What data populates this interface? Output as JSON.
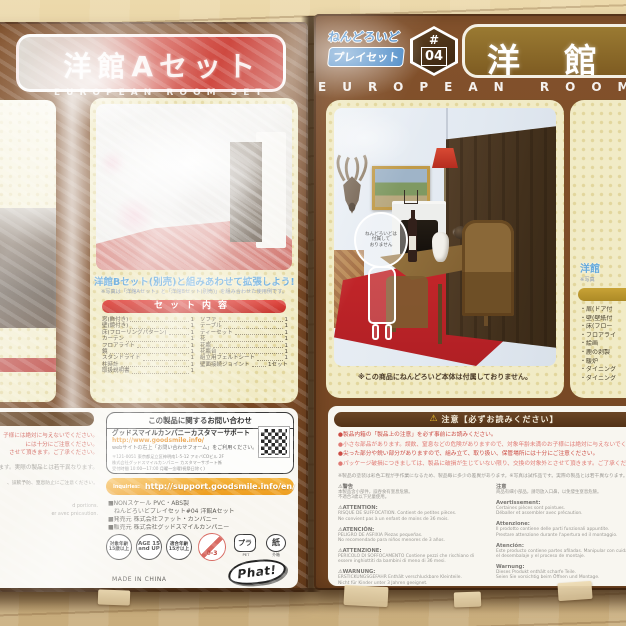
{
  "left_box": {
    "title": "洋館Aセット",
    "subtitle": "EUROPEAN ROOM SET",
    "headline": "洋館Bセット(別売)と組みあわせて拡張しよう!!",
    "headline_note": "※写真は「洋館Aセット」と「洋館Bセット(別売)」を組み合わせた使用例です。",
    "contents_header": "セット内容",
    "contents_col1": [
      {
        "name": "窓(飾付き)",
        "qty": "1"
      },
      {
        "name": "壁(鏡付き)",
        "qty": "1"
      },
      {
        "name": "床(フローリングパターン)",
        "qty": "1"
      },
      {
        "name": "カーテン",
        "qty": "1"
      },
      {
        "name": "フロアライト",
        "qty": "1"
      },
      {
        "name": "鏡",
        "qty": "1"
      },
      {
        "name": "スタンドライト",
        "qty": "1"
      },
      {
        "name": "柱時計",
        "qty": "1"
      },
      {
        "name": "取扱説明書",
        "qty": "1"
      }
    ],
    "contents_col2": [
      {
        "name": "ソファ",
        "qty": "1"
      },
      {
        "name": "テーブル",
        "qty": "1"
      },
      {
        "name": "ティーセット",
        "qty": "1"
      },
      {
        "name": "花",
        "qty": "1"
      },
      {
        "name": "花瓶",
        "qty": "1"
      },
      {
        "name": "花瓶台",
        "qty": "1"
      },
      {
        "name": "組立用フェルトシート",
        "qty": "1"
      },
      {
        "name": "壁面接続ジョイント",
        "qty": "1セット"
      }
    ],
    "warning_fragments": [
      "子様には絶対に与えないでください。",
      "には十分にご注意ください。",
      "させて頂きます。ご了承ください。",
      "ます。実際の製品とは若干異なります。",
      "、誤飲予防、窒息防止にご注意ください。",
      "d portions.",
      "er avec précaution."
    ],
    "contact": {
      "header": "この製品に関するお問い合わせ",
      "support": "グッドスマイルカンパニーカスタマーサポート",
      "url": "http://www.goodsmile.info/",
      "web_note": "webサイトの右上「お問い合わせフォーム」をご利用ください。",
      "address1": "〒121-0051 東京都足立区神明南1-5-12 アキバCOビル 2F",
      "address2": "株式会社グッドスマイルカンパニー カスタマーサポート係",
      "address3": "受付時間 10:00〜17:00 月曜〜金曜(祝祭日除く)"
    },
    "en_support_label": "Inquiries:",
    "en_support_url": "http://support.goodsmile.info/en/",
    "specs": [
      "■NONスケール PVC・ABS製",
      "ねんどろいどプレイセット#04 洋館Aセット",
      "■発売元 株式会社ファット・カンパニー",
      "■販売元 株式会社グッドスマイルカンパニー"
    ],
    "badges": {
      "age_jp": "対象年齢\n15歳以上",
      "age_en": "AGE 15\nand UP",
      "age_fit": "適合年齢\n15才以上",
      "ban": "0-3",
      "plastic": "プラ",
      "plastic_sub": "PET",
      "paper": "紙",
      "paper_sub": "外箱"
    },
    "maker_logo": "Phat!",
    "made_in": "MADE IN CHINA"
  },
  "right_box": {
    "logo_line1": "ねんどろいど",
    "logo_line2": "プレイセット",
    "badge_hash": "#",
    "badge_number": "04",
    "title": "洋館",
    "subtitle": "EUROPEAN ROOM",
    "figure_note": "ねんどろいどは\n付属して\nおりません",
    "photo_caption": "※この商品にねんどろいど本体は付属しておりません。",
    "side_panel": {
      "headline_fragment": "洋館",
      "note_fragment": "※写真",
      "items": [
        "扉(ドア付",
        "壁(壁紙付",
        "床(フロー",
        "フロアライ",
        "絵画",
        "鹿の剥製",
        "暖炉",
        "ダイニング",
        "ダイニング"
      ]
    },
    "warning": {
      "bar_icon": "⚠",
      "bar_text": "注意【必ずお読みください】",
      "bullets": [
        "●製品内箱の「製品上の注意」を必ず事前にお読みください。",
        "●小さな部品があります。誤飲、窒息などの危険がありますので、対象年齢未満のお子様には絶対に与えないでください。",
        "●尖った部分や鋭い部分がありますので、組み立て、取り扱い、保管場所には十分にご注意ください。",
        "●パッケージ破損につきましては、製品に破損が生じていない限り、交換の対象外とさせて頂きます。ご了承ください。"
      ],
      "note": "※製品の塗装は彩色工程が手作業になるため、製品毎に多少の差異があります。※写真は試作品です。実際の製品とは若干異なります。",
      "col_left": [
        {
          "head": "⚠警告",
          "body": "本製品含小部件，誤吞食有窒息危險。\n不適合3歲以下兒童使用。"
        },
        {
          "head": "⚠ATTENTION:",
          "body": "RISQUE DE SUFFOCATION. Contient de petites pièces.\nNe convient pas à un enfant de moins de 36 mois."
        },
        {
          "head": "⚠ATENCIÓN:",
          "body": "PELIGRO DE ASFIXIA Piezas pequeñas.\nNo recomendado para niños menores de 3 años."
        },
        {
          "head": "⚠ATTENZIONE:",
          "body": "PERICOLO DI SOFFOCAMENTO Contiene pezzi che rischiano di essere inghiottiti da bambini di meno di 36 mesi."
        },
        {
          "head": "⚠WARNUNG:",
          "body": "ERSTICKUNGSGEFAHR Enthält verschluckbare Kleinteile.\nNicht für Kinder unter 3 Jahren geeignet."
        }
      ],
      "col_right": [
        {
          "head": "注意",
          "body": "商品有細小部品，請勿放入口鼻，以免發生窒息危險。"
        },
        {
          "head": "Avertissement:",
          "body": "Certaines pièces sont pointues.\nDéballer et assembler avec précaution."
        },
        {
          "head": "Attenzione:",
          "body": "Il prodotto contiene delle parti funzionali appuntite.\nPrestare attenzione durante l'apertura ed il montaggio."
        },
        {
          "head": "Atención:",
          "body": "Este producto contiene partes afiladas. Manipular con cuidado durante el desembalaje y el proceso de montaje."
        },
        {
          "head": "Warnung:",
          "body": "Dieses Produkt enthält scharfe Teile.\nSeien Sie vorsichtig beim Öffnen und Montage."
        }
      ]
    }
  },
  "colors": {
    "banner_red": "#c93127",
    "banner_brown": "#8a6a2e",
    "panel_cream": "#f1ebc6",
    "carpet_red": "#c3242a",
    "accent_orange": "#f0a42c",
    "logo_blue": "#3a7fc1"
  }
}
